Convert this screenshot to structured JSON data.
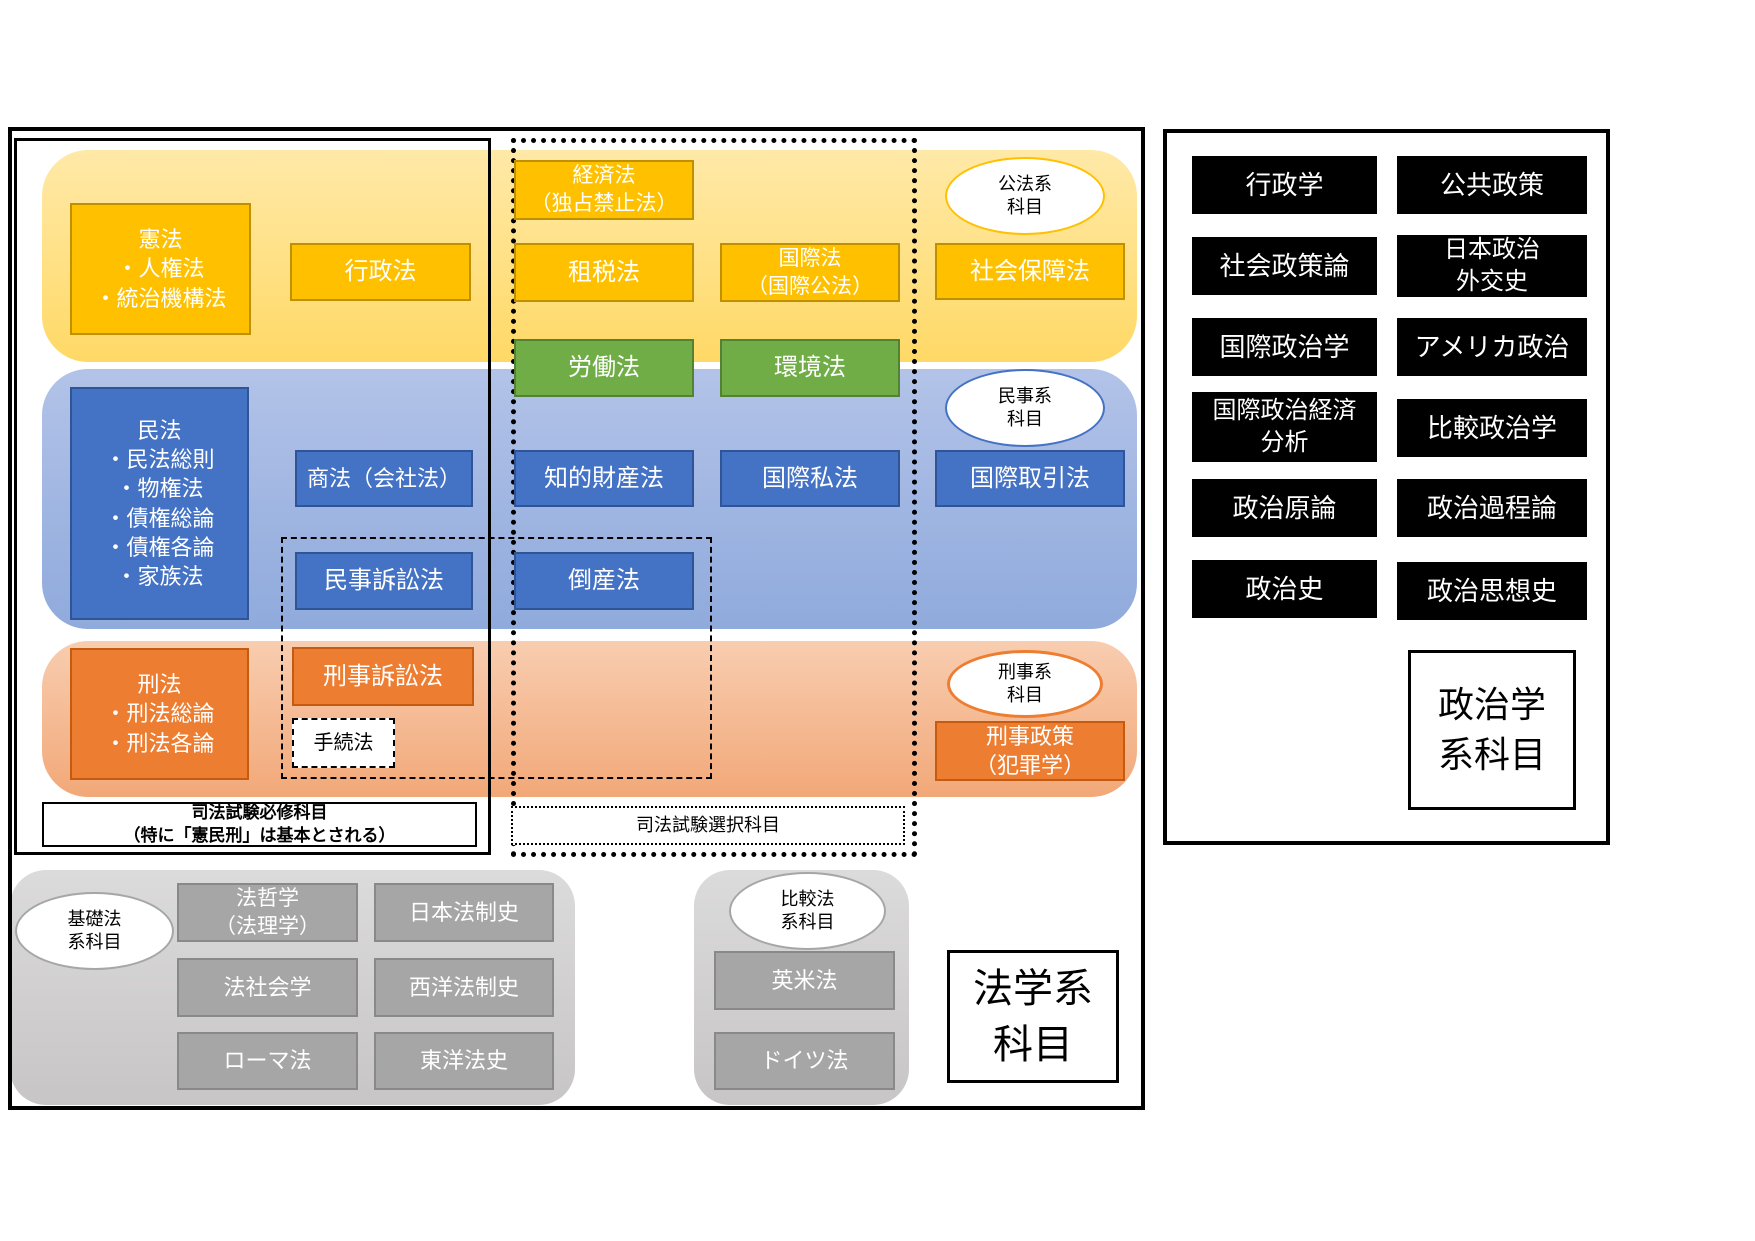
{
  "colors": {
    "gold_box": "#FFC000",
    "gold_band": "#FFD966",
    "blue_box": "#4472C4",
    "blue_band": "#8FAADC",
    "orange_box": "#ED7D31",
    "orange_band": "#F4B183",
    "green_box": "#70AD47",
    "gray_box": "#A6A6A6",
    "gray_band": "#D0CECE",
    "black_box": "#000000",
    "frame": "#000000"
  },
  "law": {
    "required_label": {
      "l1": "司法試験必修科目",
      "l2": "（特に「憲民刑」は基本とされる）"
    },
    "elective_label": "司法試験選択科目",
    "panel_label": {
      "l1": "法学系",
      "l2": "科目"
    },
    "ovals": {
      "public": {
        "l1": "公法系",
        "l2": "科目"
      },
      "civil": {
        "l1": "民事系",
        "l2": "科目"
      },
      "criminal": {
        "l1": "刑事系",
        "l2": "科目"
      },
      "basic": {
        "l1": "基礎法",
        "l2": "系科目"
      },
      "comparative": {
        "l1": "比較法",
        "l2": "系科目"
      }
    },
    "boxes": {
      "kenpo": {
        "l1": "憲法",
        "l2": "・人権法",
        "l3": "・統治機構法"
      },
      "gyosei": "行政法",
      "keizai": {
        "l1": "経済法",
        "l2": "（独占禁止法）"
      },
      "sozei": "租税法",
      "kokusai": {
        "l1": "国際法",
        "l2": "（国際公法）"
      },
      "shakai_hosho": "社会保障法",
      "rodo": "労働法",
      "kankyo": "環境法",
      "minpo": {
        "l1": "民法",
        "l2": "・民法総則",
        "l3": "・物権法",
        "l4": "・債権総論",
        "l5": "・債権各論",
        "l6": "・家族法"
      },
      "shoho": "商法（会社法）",
      "chizai": "知的財産法",
      "kokusai_shiho": "国際私法",
      "kokusai_torihiki": "国際取引法",
      "minji_sosho": "民事訴訟法",
      "tosan": "倒産法",
      "keiho": {
        "l1": "刑法",
        "l2": "・刑法総論",
        "l3": "・刑法各論"
      },
      "keiji_sosho": "刑事訴訟法",
      "tetsuzuki": "手続法",
      "keiji_seisaku": {
        "l1": "刑事政策",
        "l2": "（犯罪学）"
      },
      "hotetsugaku": {
        "l1": "法哲学",
        "l2": "（法理学）"
      },
      "nihon_hoseishi": "日本法制史",
      "ho_shakaigaku": "法社会学",
      "seiyo_hoseishi": "西洋法制史",
      "roma_ho": "ローマ法",
      "toyo_hoshi": "東洋法史",
      "eibei_ho": "英米法",
      "doitsu_ho": "ドイツ法"
    }
  },
  "political": {
    "panel_label": {
      "l1": "政治学",
      "l2": "系科目"
    },
    "items": [
      {
        "l1": "行政学"
      },
      {
        "l1": "公共政策"
      },
      {
        "l1": "社会政策論"
      },
      {
        "l1": "日本政治",
        "l2": "外交史"
      },
      {
        "l1": "国際政治学"
      },
      {
        "l1": "アメリカ政治"
      },
      {
        "l1": "国際政治経済",
        "l2": "分析"
      },
      {
        "l1": "比較政治学"
      },
      {
        "l1": "政治原論"
      },
      {
        "l1": "政治過程論"
      },
      {
        "l1": "政治史"
      },
      {
        "l1": "政治思想史"
      }
    ]
  }
}
